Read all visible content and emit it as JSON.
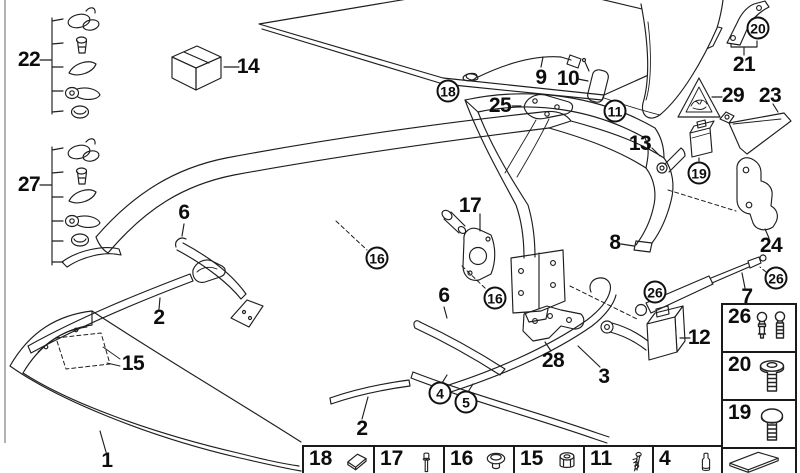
{
  "diagram": {
    "description": "Convertible folding top parts exploded diagram",
    "colors": {
      "line": "#1e1e1e",
      "kit_box_top": "#b5b5b5",
      "kit_box_left": "#9b9b9b",
      "kit_box_right": "#878787",
      "background": "#ffffff"
    },
    "labels": [
      {
        "text": "22",
        "x": 29,
        "y": 60,
        "kind": "plain"
      },
      {
        "text": "27",
        "x": 29,
        "y": 185,
        "kind": "plain"
      },
      {
        "text": "14",
        "x": 248,
        "y": 67,
        "kind": "plain"
      },
      {
        "text": "9",
        "x": 541,
        "y": 78,
        "kind": "plain"
      },
      {
        "text": "10",
        "x": 568,
        "y": 79,
        "kind": "plain"
      },
      {
        "text": "25",
        "x": 500,
        "y": 106,
        "kind": "plain"
      },
      {
        "text": "13",
        "x": 640,
        "y": 144,
        "kind": "plain"
      },
      {
        "text": "21",
        "x": 744,
        "y": 65,
        "kind": "plain"
      },
      {
        "text": "29",
        "x": 733,
        "y": 96,
        "kind": "plain"
      },
      {
        "text": "23",
        "x": 770,
        "y": 96,
        "kind": "plain"
      },
      {
        "text": "8",
        "x": 615,
        "y": 243,
        "kind": "plain"
      },
      {
        "text": "24",
        "x": 771,
        "y": 246,
        "kind": "plain"
      },
      {
        "text": "7",
        "x": 747,
        "y": 297,
        "kind": "plain"
      },
      {
        "text": "12",
        "x": 699,
        "y": 338,
        "kind": "plain"
      },
      {
        "text": "6",
        "x": 184,
        "y": 213,
        "kind": "plain"
      },
      {
        "text": "6",
        "x": 444,
        "y": 296,
        "kind": "plain"
      },
      {
        "text": "17",
        "x": 470,
        "y": 206,
        "kind": "plain"
      },
      {
        "text": "2",
        "x": 159,
        "y": 318,
        "kind": "plain"
      },
      {
        "text": "15",
        "x": 133,
        "y": 364,
        "kind": "plain"
      },
      {
        "text": "2",
        "x": 362,
        "y": 429,
        "kind": "plain"
      },
      {
        "text": "3",
        "x": 604,
        "y": 377,
        "kind": "plain"
      },
      {
        "text": "28",
        "x": 553,
        "y": 361,
        "kind": "plain"
      },
      {
        "text": "1",
        "x": 107,
        "y": 461,
        "kind": "plain"
      },
      {
        "text": "18",
        "x": 448,
        "y": 91,
        "kind": "circled"
      },
      {
        "text": "11",
        "x": 615,
        "y": 111,
        "kind": "circled"
      },
      {
        "text": "19",
        "x": 699,
        "y": 173,
        "kind": "circled"
      },
      {
        "text": "16",
        "x": 377,
        "y": 258,
        "kind": "circled"
      },
      {
        "text": "16",
        "x": 495,
        "y": 298,
        "kind": "circled"
      },
      {
        "text": "26",
        "x": 655,
        "y": 292,
        "kind": "circled"
      },
      {
        "text": "26",
        "x": 776,
        "y": 278,
        "kind": "circled"
      },
      {
        "text": "20",
        "x": 758,
        "y": 28,
        "kind": "circled"
      },
      {
        "text": "4",
        "x": 440,
        "y": 393,
        "kind": "circled"
      },
      {
        "text": "5",
        "x": 466,
        "y": 402,
        "kind": "circled"
      }
    ],
    "hardware_groups": [
      {
        "label": "22",
        "items": [
          "clamp",
          "screw",
          "rubber-wedge",
          "lever",
          "cap"
        ]
      },
      {
        "label": "27",
        "items": [
          "clamp",
          "screw",
          "rubber-wedge",
          "lever",
          "cap",
          "ramp"
        ]
      }
    ],
    "legend_right": {
      "cells": [
        {
          "number": "26",
          "icon": "ball-studs"
        },
        {
          "number": "20",
          "icon": "flange-screw"
        },
        {
          "number": "19",
          "icon": "round-screw"
        },
        {
          "number": "",
          "icon": "wedge"
        }
      ]
    },
    "legend_bottom": {
      "cells": [
        {
          "number": "18",
          "icon": "pad"
        },
        {
          "number": "17",
          "icon": "bolt"
        },
        {
          "number": "16",
          "icon": "dome-plug"
        },
        {
          "number": "15",
          "icon": "grommet"
        },
        {
          "number": "11",
          "icon": "spring-pin"
        },
        {
          "number": "4",
          "icon": "pin"
        }
      ]
    }
  }
}
